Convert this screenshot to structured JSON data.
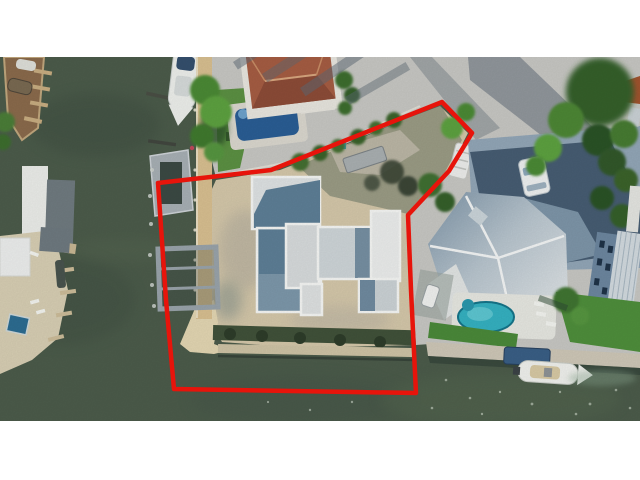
{
  "meta": {
    "kind": "aerial-drone-photograph",
    "description": "Real-estate aerial photo of a waterfront vacant lot with a new flat-roof house under construction, outlined with a red property-boundary line; canal water on the left, neighboring homes, pools, docks and boats around it; white letterbox bars top and bottom.",
    "visible_text": "",
    "canvas": {
      "width": 640,
      "height": 480
    },
    "photo_area": {
      "top": 57,
      "height": 364
    }
  },
  "outline": {
    "label": "property-boundary",
    "points": "442,102 472,133 449,171 408,215 411,290 416,393 174,389 166,300 158,183 271,170",
    "stroke_width": 4.5
  },
  "colors": {
    "frame_bg": "#ffffff",
    "outline_red": "#e7140b",
    "water": "#4c5c4b",
    "water_deep": "#3e4e41",
    "water_light": "#5a6a52",
    "street": "#c8c8c4",
    "sand": "#d5c8aa",
    "beach": "#e4d7b3",
    "seawall_tan": "#d9c091",
    "deck_tan": "#d8cfb4",
    "dock_brown": "#8b6b4c",
    "lawn": "#5c9143",
    "lawn_dark": "#4b8a3a",
    "tree_dark": "#2c5226",
    "tree_mid": "#44792f",
    "tree_light": "#5da23f",
    "terracotta_roof": "#a65d43",
    "pool_blue": "#2a5e95",
    "pool_teal": "#35b2c2",
    "pavers": "#93a7b8",
    "paver_shadow": "#3f556b",
    "roof_shadow_blue": "#7e96a9",
    "roof_lit": "#e3e6e7",
    "building_white": "#f6f7f5",
    "block_shadow": "#6a89a0",
    "boat_white": "#f1f2ee",
    "canopy_blue": "#3a5f86",
    "metal_roof": "#d3dbe0",
    "wall_blue": "#6d87a0"
  },
  "scene": {
    "elements": [
      {
        "name": "canal-water",
        "desc": "dark green canal water filling the left and bottom of the frame"
      },
      {
        "name": "marina-dock",
        "desc": "brown marina dock with finger piers and small boats, top-left edge"
      },
      {
        "name": "moored-yacht",
        "desc": "white yacht with navy bimini moored at top center-left"
      },
      {
        "name": "left-neighbor-property",
        "desc": "tan pool deck, white roofs, small blue spa and finger piers across the canal"
      },
      {
        "name": "subject-lot",
        "desc": "sandy construction lot inside the red outline"
      },
      {
        "name": "construction-house",
        "desc": "new flat-roof house: white parapet walls, gray/blue roof planes"
      },
      {
        "name": "boat-lift-dock",
        "desc": "gray boat-lift frames and dock on the lot's canal side"
      },
      {
        "name": "terracotta-roof-house",
        "desc": "neighbor house with orange tile roof and dark blue pool, top center"
      },
      {
        "name": "street-pavement",
        "desc": "pale concrete street with long palm shadows, top right"
      },
      {
        "name": "paver-driveway",
        "desc": "blue-gray paver driveway with parked white car"
      },
      {
        "name": "neighbor-house",
        "desc": "large home with pale hip metal roof, teal pool, lawns, right side"
      },
      {
        "name": "motor-boat",
        "desc": "white center-console boat and navy canopy lift at bottom right dock"
      },
      {
        "name": "property-boundary-outline",
        "desc": "thick red polygon marking the listed parcel"
      }
    ]
  }
}
